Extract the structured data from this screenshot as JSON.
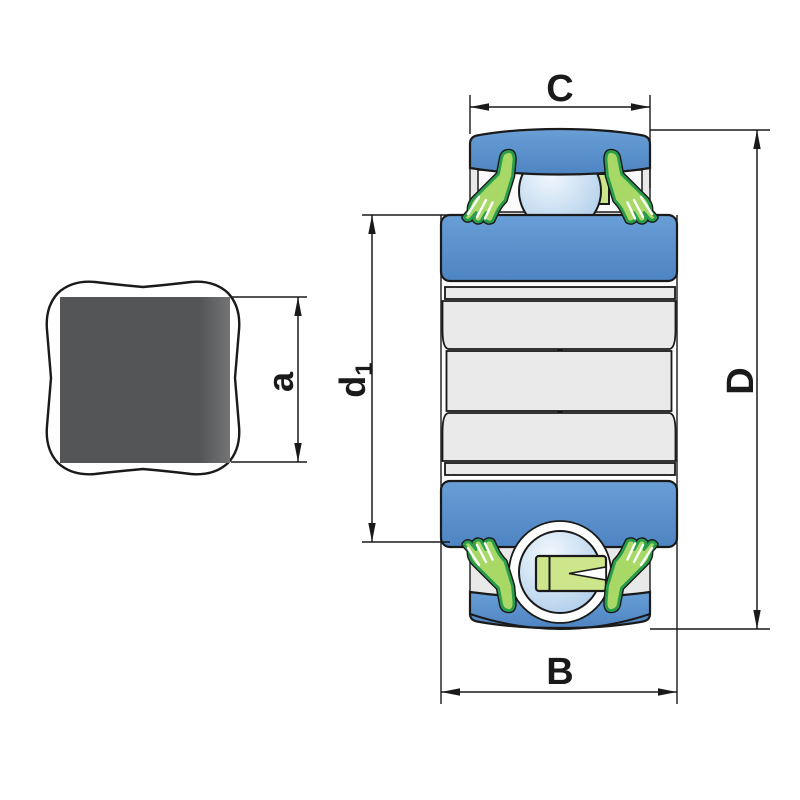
{
  "title": "Insert bearing with square bore - dimension drawing",
  "labels": {
    "top_width": "C",
    "outside_diameter": "D",
    "bottom_width": "B",
    "bore_size": "a",
    "inner_diameter_base": "d",
    "inner_diameter_sub": "1"
  },
  "parts": [
    "square-bore-outline",
    "square-bore-fill",
    "outer-ring",
    "inner-ring",
    "ball",
    "seal",
    "cage"
  ],
  "colors": {
    "line": "#1a1a1a",
    "paper_white": "#ffffff",
    "ring_blue_light": "#699fd6",
    "ring_blue_dark": "#4d84c2",
    "ball_highlight": "#f2f8fe",
    "ball_shadow": "#a9cae8",
    "seal_outline_green": "#2a9d4c",
    "seal_fill_green": "#a8d967",
    "cage_fill": "#cde58b",
    "band_gray": "#eaeaea",
    "steel_gray": "#e9e9e9",
    "bore_fill_dark": "#545556",
    "bore_fill_light": "#737476"
  }
}
